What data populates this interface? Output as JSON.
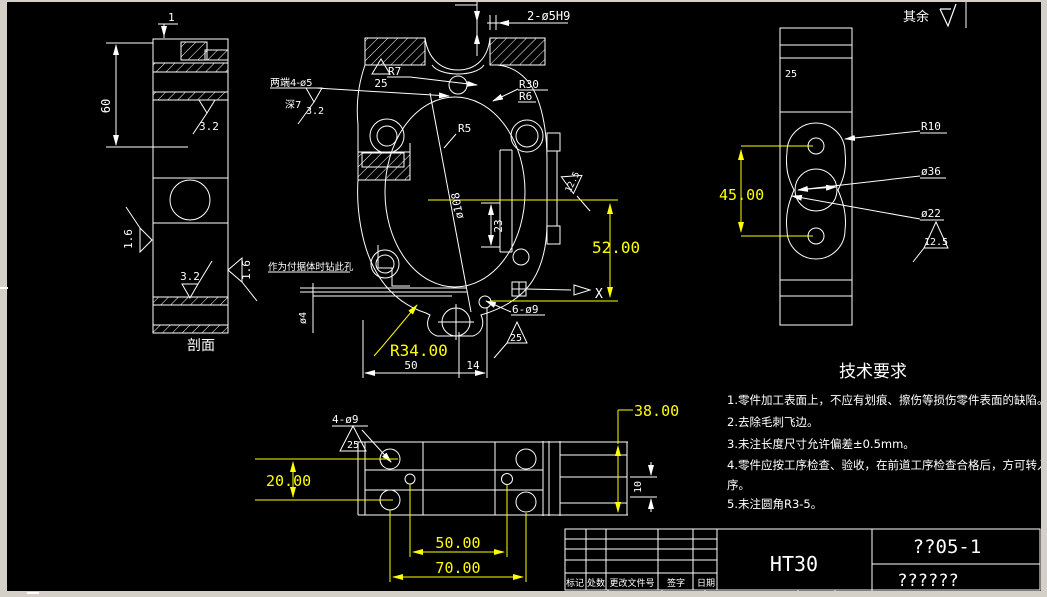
{
  "window": {
    "frame_color": "#d4d0c8",
    "canvas_color": "#000000",
    "line_color": "#ffffff",
    "highlight_color": "#ffff00",
    "surface_note": "其余"
  },
  "left_view": {
    "caption": "剖面",
    "dim_1": "1",
    "dim_60": "60",
    "roughness_top": "3.2",
    "roughness_left": "1.6",
    "roughness_right": "1.6",
    "roughness_bottom": "3.2"
  },
  "main_view": {
    "holes_top": "2-ø5H9",
    "slot_note": "两端4-ø5",
    "slot_depth": "深7",
    "slot_roughness": "3.2",
    "roughness_25": "25",
    "r7": "R7",
    "r30": "R30",
    "r6": "R6",
    "r5": "R5",
    "dia_108": "ø108",
    "dim_23": "23",
    "roughness_125": "12.5",
    "dim_52": "52.00",
    "datum_x": "X",
    "drill_note": "作为付据体时钻此孔",
    "dia_4": "ø4",
    "r34": "R34.00",
    "dim_50": "50",
    "dim_14": "14",
    "holes_bottom": "6-ø9",
    "roughness_25b": "25"
  },
  "right_view": {
    "dim_25": "25",
    "dim_45": "45.00",
    "r10": "R10",
    "dia_36": "ø36",
    "dia_22": "ø22",
    "roughness_125": "12.5"
  },
  "bottom_view": {
    "holes": "4-ø9",
    "roughness_25": "25",
    "dim_20": "20.00",
    "dim_50": "50.00",
    "dim_70": "70.00",
    "dim_38": "38.00",
    "dim_10": "10"
  },
  "tech_requirements": {
    "title": "技术要求",
    "lines": [
      "1.零件加工表面上，不应有划痕、擦伤等损伤零件表面的缺陷。",
      "2.去除毛刺飞边。",
      "3.未注长度尺寸允许偏差±0.5mm。",
      "4.零件应按工序检查、验收，在前道工序检查合格后，方可转入下道工",
      "序。",
      "5.未注圆角R3-5。"
    ]
  },
  "title_block": {
    "material": "HT30",
    "drawing_code": "??05-1",
    "drawing_name": "??????",
    "col_labels": [
      "标记",
      "处数",
      "更改文件号",
      "签字",
      "日期"
    ]
  }
}
